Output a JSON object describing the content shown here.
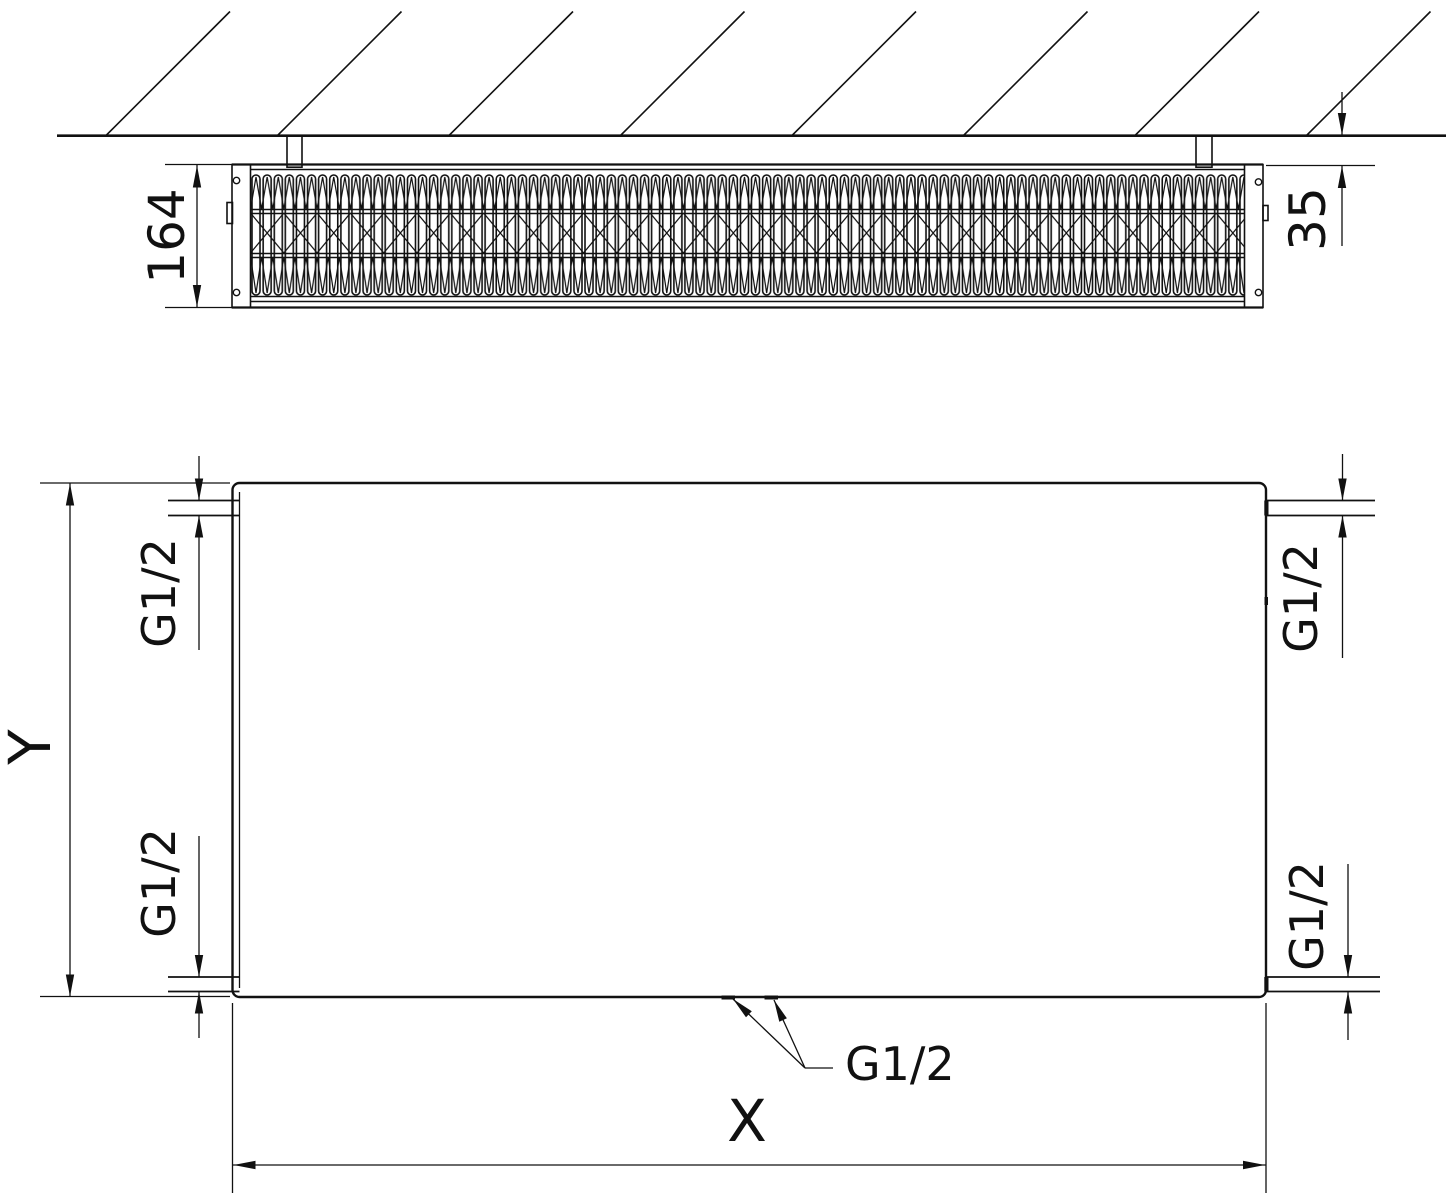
{
  "top_view": {
    "depth_dim": "164",
    "wall_clearance_dim": "35"
  },
  "front_view": {
    "width_dim": "X",
    "height_dim": "Y",
    "connections": {
      "top_left": "G1/2",
      "top_right": "G1/2",
      "bottom_left": "G1/2",
      "bottom_right": "G1/2",
      "bottom_center": "G1/2"
    }
  }
}
